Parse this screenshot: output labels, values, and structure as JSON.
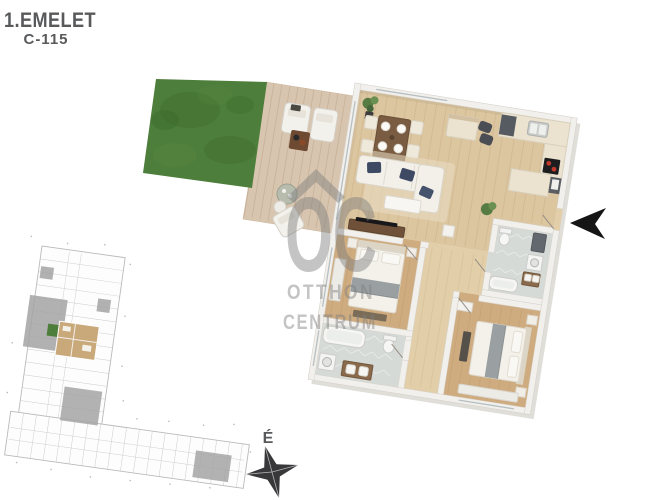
{
  "title": {
    "floor_label": "1.EMELET",
    "unit_label": "C-115"
  },
  "watermark": {
    "logo_text": "OC",
    "line1": "OTTHON",
    "line2": "CENTRUM"
  },
  "compass": {
    "north_label": "É"
  },
  "palette": {
    "background": "#ffffff",
    "title_color": "#58595b",
    "wall": "#f2f0ec",
    "wood_living": "#dcc6a0",
    "wood_corridor": "#e2cfa9",
    "wood_bedroom": "#cfac80",
    "tile_bath": "#d6dad6",
    "deck": "#d8c5af",
    "grass": "#4e7e3b",
    "counter": "#ebe3cf",
    "navy_pillow": "#3e4a63",
    "watermark": "#7d7d7d",
    "compass": "#38383a",
    "siteplan_gray": "#a4a4a4",
    "siteplan_unit": "#c9a87a",
    "arrow": "#151515"
  }
}
